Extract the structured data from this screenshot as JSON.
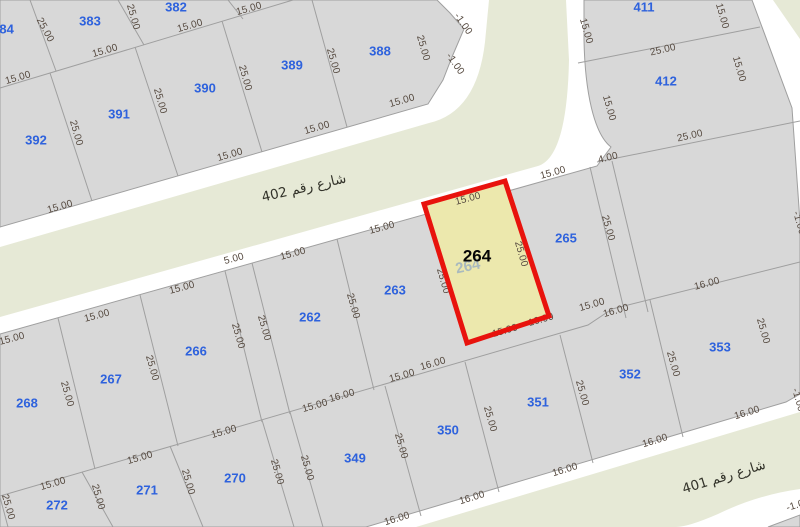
{
  "map": {
    "colors": {
      "parcel_fill": "#d8d8d8",
      "street_fill": "#e6e9d6",
      "boundary_line": "#9f9f9f",
      "highlight_fill": "#ece8ad",
      "highlight_border": "#e8130d",
      "parcel_number_color": "#2e62dd",
      "dimension_color": "#564a40"
    },
    "highlighted_parcel": {
      "number_bold": "264",
      "number_faint": "264"
    },
    "street_labels": [
      {
        "t": "شارع رقم 402",
        "x": 304,
        "y": 188,
        "r": -13
      },
      {
        "t": "شارع رقم 401",
        "x": 724,
        "y": 477,
        "r": -17
      }
    ],
    "parcel_labels": [
      {
        "t": "384",
        "x": 3,
        "y": 30
      },
      {
        "t": "383",
        "x": 90,
        "y": 22
      },
      {
        "t": "382",
        "x": 176,
        "y": 8
      },
      {
        "t": "392",
        "x": 36,
        "y": 141
      },
      {
        "t": "391",
        "x": 119,
        "y": 115
      },
      {
        "t": "390",
        "x": 205,
        "y": 89
      },
      {
        "t": "389",
        "x": 292,
        "y": 66
      },
      {
        "t": "388",
        "x": 380,
        "y": 52
      },
      {
        "t": "411",
        "x": 644,
        "y": 8
      },
      {
        "t": "412",
        "x": 666,
        "y": 82
      },
      {
        "t": "268",
        "x": 27,
        "y": 404
      },
      {
        "t": "267",
        "x": 111,
        "y": 380
      },
      {
        "t": "266",
        "x": 196,
        "y": 352
      },
      {
        "t": "262",
        "x": 310,
        "y": 318
      },
      {
        "t": "263",
        "x": 395,
        "y": 291
      },
      {
        "t": "265",
        "x": 566,
        "y": 239
      },
      {
        "t": "272",
        "x": 57,
        "y": 506
      },
      {
        "t": "271",
        "x": 147,
        "y": 491
      },
      {
        "t": "270",
        "x": 235,
        "y": 479
      },
      {
        "t": "349",
        "x": 355,
        "y": 459
      },
      {
        "t": "350",
        "x": 448,
        "y": 431
      },
      {
        "t": "351",
        "x": 538,
        "y": 403
      },
      {
        "t": "352",
        "x": 630,
        "y": 375
      },
      {
        "t": "353",
        "x": 720,
        "y": 348
      }
    ],
    "dimension_labels": [
      {
        "t": "25.00",
        "x": 45,
        "y": 30,
        "r": 62
      },
      {
        "t": "25.00",
        "x": 133,
        "y": 17,
        "r": 74
      },
      {
        "t": "15.00",
        "x": 105,
        "y": 51,
        "r": -16
      },
      {
        "t": "15.00",
        "x": 190,
        "y": 26,
        "r": -16
      },
      {
        "t": "15.00",
        "x": 249,
        "y": 9,
        "r": -16
      },
      {
        "t": "15.00",
        "x": 18,
        "y": 78,
        "r": -16
      },
      {
        "t": "25.00",
        "x": 76,
        "y": 133,
        "r": 74
      },
      {
        "t": "25.00",
        "x": 160,
        "y": 101,
        "r": 74
      },
      {
        "t": "25.00",
        "x": 245,
        "y": 78,
        "r": 74
      },
      {
        "t": "25.00",
        "x": 333,
        "y": 61,
        "r": 74
      },
      {
        "t": "25.00",
        "x": 423,
        "y": 48,
        "r": 74
      },
      {
        "t": "15.00",
        "x": 230,
        "y": 155,
        "r": -16
      },
      {
        "t": "15.00",
        "x": 60,
        "y": 207,
        "r": -16
      },
      {
        "t": "15.00",
        "x": 317,
        "y": 128,
        "r": -16
      },
      {
        "t": "15.00",
        "x": 402,
        "y": 101,
        "r": -16
      },
      {
        "t": "-1.00",
        "x": 463,
        "y": 24,
        "r": 55
      },
      {
        "t": "-1.00",
        "x": 455,
        "y": 64,
        "r": 55
      },
      {
        "t": "15.00",
        "x": 586,
        "y": 31,
        "r": 74
      },
      {
        "t": "15.00",
        "x": 722,
        "y": 16,
        "r": 74
      },
      {
        "t": "25.00",
        "x": 663,
        "y": 50,
        "r": -13
      },
      {
        "t": "15.00",
        "x": 739,
        "y": 69,
        "r": 74
      },
      {
        "t": "15.00",
        "x": 609,
        "y": 108,
        "r": 74
      },
      {
        "t": "25.00",
        "x": 690,
        "y": 136,
        "r": -13
      },
      {
        "t": "4.00",
        "x": 608,
        "y": 158,
        "r": -14
      },
      {
        "t": "-1.00",
        "x": 799,
        "y": 223,
        "r": 74
      },
      {
        "t": "15.00",
        "x": 553,
        "y": 173,
        "r": -15
      },
      {
        "t": "25.00",
        "x": 608,
        "y": 228,
        "r": 74
      },
      {
        "t": "15.00",
        "x": 468,
        "y": 199,
        "r": -15
      },
      {
        "t": "25.00",
        "x": 443,
        "y": 281,
        "r": 74
      },
      {
        "t": "25.00",
        "x": 521,
        "y": 254,
        "r": 74
      },
      {
        "t": "15.00",
        "x": 382,
        "y": 228,
        "r": -15
      },
      {
        "t": "25.00",
        "x": 353,
        "y": 306,
        "r": 74
      },
      {
        "t": "15.00",
        "x": 293,
        "y": 254,
        "r": -15
      },
      {
        "t": "5.00",
        "x": 234,
        "y": 259,
        "r": -15
      },
      {
        "t": "25.00",
        "x": 264,
        "y": 328,
        "r": 74
      },
      {
        "t": "25.00",
        "x": 238,
        "y": 336,
        "r": 74
      },
      {
        "t": "15.00",
        "x": 182,
        "y": 288,
        "r": -15
      },
      {
        "t": "25.00",
        "x": 152,
        "y": 368,
        "r": 74
      },
      {
        "t": "15.00",
        "x": 97,
        "y": 316,
        "r": -15
      },
      {
        "t": "25.00",
        "x": 67,
        "y": 394,
        "r": 74
      },
      {
        "t": "15.00",
        "x": 12,
        "y": 339,
        "r": -15
      },
      {
        "t": "15.00",
        "x": 53,
        "y": 484,
        "r": -16
      },
      {
        "t": "25.00",
        "x": 8,
        "y": 507,
        "r": 74
      },
      {
        "t": "25.00",
        "x": 98,
        "y": 497,
        "r": 74
      },
      {
        "t": "15.00",
        "x": 140,
        "y": 458,
        "r": -16
      },
      {
        "t": "25.00",
        "x": 188,
        "y": 482,
        "r": 74
      },
      {
        "t": "15.00",
        "x": 224,
        "y": 432,
        "r": -16
      },
      {
        "t": "25.00",
        "x": 277,
        "y": 472,
        "r": 74
      },
      {
        "t": "25.00",
        "x": 307,
        "y": 468,
        "r": 74
      },
      {
        "t": "15.00",
        "x": 315,
        "y": 406,
        "r": -16
      },
      {
        "t": "16.00",
        "x": 342,
        "y": 396,
        "r": -16
      },
      {
        "t": "25.00",
        "x": 401,
        "y": 446,
        "r": 74
      },
      {
        "t": "15.00",
        "x": 402,
        "y": 376,
        "r": -16
      },
      {
        "t": "16.00",
        "x": 433,
        "y": 364,
        "r": -16
      },
      {
        "t": "25.00",
        "x": 490,
        "y": 419,
        "r": 74
      },
      {
        "t": "15.00",
        "x": 505,
        "y": 331,
        "r": -16
      },
      {
        "t": "16.00",
        "x": 541,
        "y": 320,
        "r": -16
      },
      {
        "t": "25.00",
        "x": 582,
        "y": 393,
        "r": 74
      },
      {
        "t": "15.00",
        "x": 592,
        "y": 305,
        "r": -16
      },
      {
        "t": "16.00",
        "x": 616,
        "y": 311,
        "r": -16
      },
      {
        "t": "25.00",
        "x": 673,
        "y": 364,
        "r": 74
      },
      {
        "t": "16.00",
        "x": 707,
        "y": 284,
        "r": -15
      },
      {
        "t": "25.00",
        "x": 763,
        "y": 331,
        "r": 74
      },
      {
        "t": "16.00",
        "x": 397,
        "y": 519,
        "r": -17
      },
      {
        "t": "16.00",
        "x": 472,
        "y": 498,
        "r": -17
      },
      {
        "t": "16.00",
        "x": 565,
        "y": 470,
        "r": -17
      },
      {
        "t": "16.00",
        "x": 655,
        "y": 441,
        "r": -17
      },
      {
        "t": "16.00",
        "x": 747,
        "y": 413,
        "r": -17
      },
      {
        "t": "-1.00",
        "x": 798,
        "y": 400,
        "r": 74
      },
      {
        "t": "-1.00",
        "x": 798,
        "y": 505,
        "r": -17
      }
    ]
  }
}
